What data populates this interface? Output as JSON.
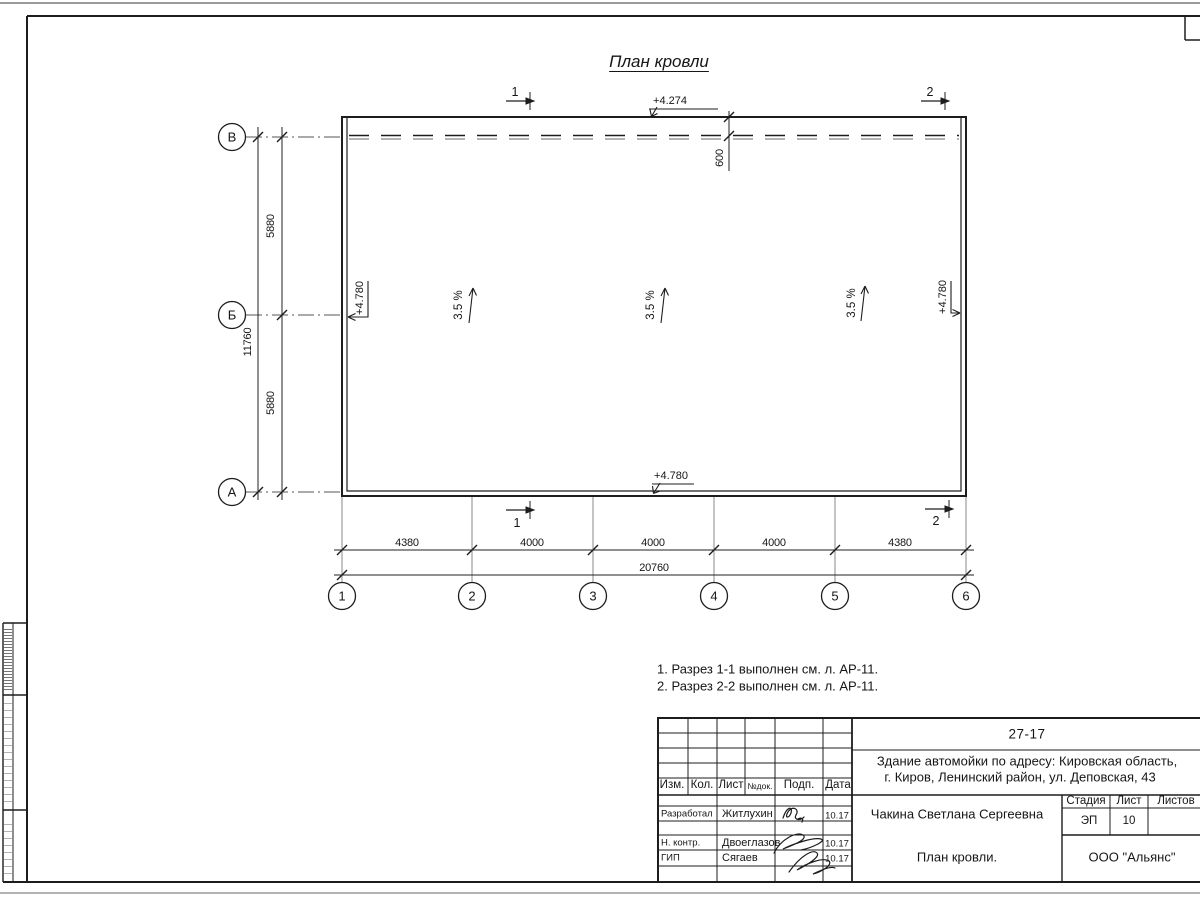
{
  "drawing": {
    "title": "План кровли",
    "notes": [
      "1. Разрез 1-1 выполнен см. л. АР-11.",
      "2. Разрез 2-2 выполнен см. л. АР-11."
    ],
    "axes": {
      "columns": [
        "1",
        "2",
        "3",
        "4",
        "5",
        "6"
      ],
      "rows": [
        "В",
        "Б",
        "А"
      ]
    },
    "dims": {
      "bottom_segments": [
        "4380",
        "4000",
        "4000",
        "4000",
        "4380"
      ],
      "bottom_total": "20760",
      "left_segments": [
        "5880",
        "5880"
      ],
      "left_total": "11760",
      "canopy_offset": "600"
    },
    "elevations": {
      "canopy": "+4.274",
      "roof": "+4.780"
    },
    "slope": "3.5 %",
    "sections": {
      "s1": "1",
      "s2": "2"
    }
  },
  "title_block": {
    "project_code": "27-17",
    "address_line1": "Здание автомойки по адресу: Кировская область,",
    "address_line2": "г. Киров, Ленинский район, ул. Деповская, 43",
    "header_cols": [
      "Изм.",
      "Кол.",
      "Лист",
      "№док.",
      "Подп.",
      "Дата"
    ],
    "rows": [
      {
        "role": "Разработал",
        "name": "Житлухин",
        "date": "10.17"
      },
      {
        "role": "Н. контр.",
        "name": "Двоеглазов",
        "date": "10.17"
      },
      {
        "role": "ГИП",
        "name": "Сягаев",
        "date": "10.17"
      }
    ],
    "author": "Чакина Светлана Сергеевна",
    "sheet_title": "План кровли.",
    "stage_label": "Стадия",
    "sheet_label": "Лист",
    "sheets_label": "Листов",
    "stage": "ЭП",
    "sheet_number": "10",
    "company": "ООО \"Альянс\""
  }
}
